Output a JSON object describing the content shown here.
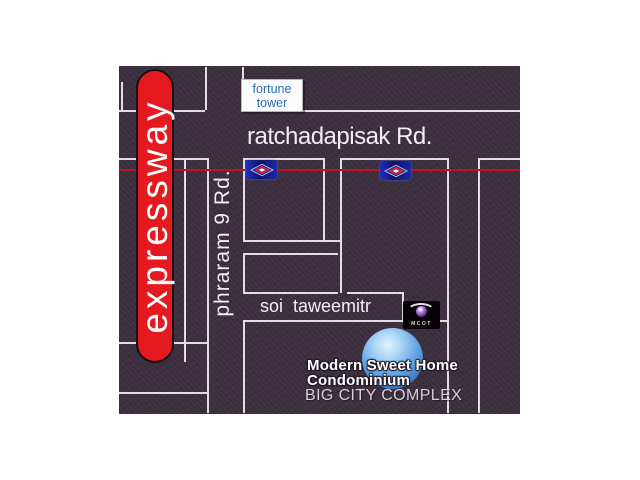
{
  "theme": {
    "page_bg": "#ffffff",
    "map_bg": "#3a2d3c",
    "road_line": "#e2dde3",
    "metro_red": "#c3121f",
    "expressway_red": "#e5191f",
    "label_white": "#f2eef2",
    "fortune_blue": "#2a6cb3",
    "complex_text": "#d6d0da",
    "mrt_marker_blue": "#0c1468",
    "mrt_marker_red": "#d5262c",
    "sphere_blue": "#64a6e4"
  },
  "labels": {
    "expressway": "expressway",
    "ratchadapisak_road": "ratchadapisak Rd.",
    "phraram9_road": "phraram 9 Rd.",
    "soi_taweemitr": "soi taweemitr",
    "fortune_tower": {
      "line1": "fortune",
      "line2": "tower"
    },
    "destination": {
      "line1": "Modern Sweet Home",
      "line2": "Condominium"
    },
    "big_city_complex": "BIG CITY COMPLEX",
    "mcot_logo_text": "MCOT"
  },
  "icons": {
    "station_marker": "mrt-station-diamond-icon",
    "broadcaster_logo": "mcot-eye-logo-icon",
    "location_marker": "blue-sphere-location-icon"
  }
}
